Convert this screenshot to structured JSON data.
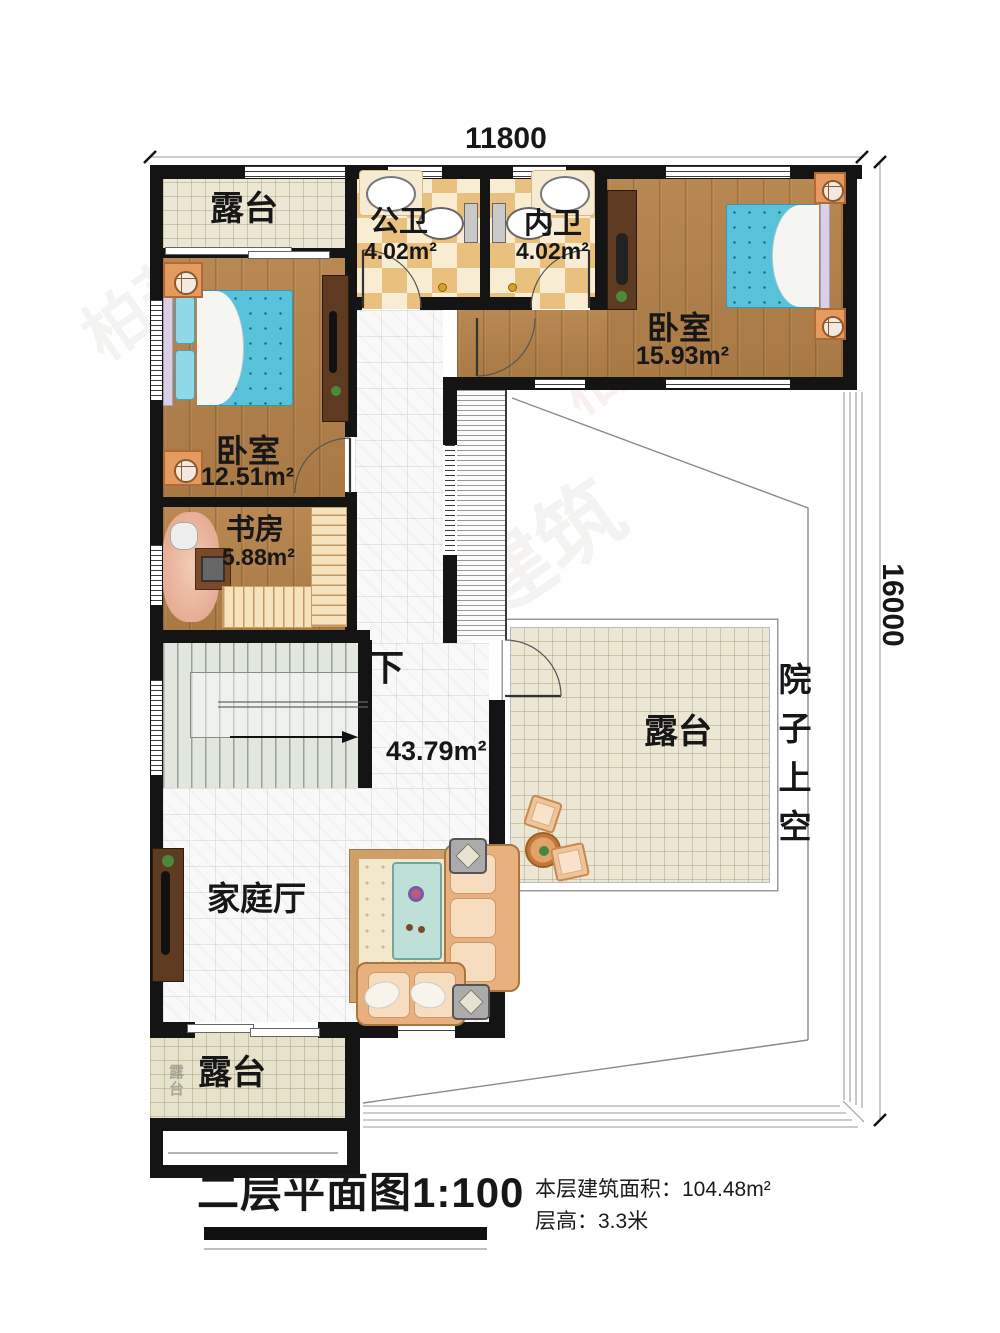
{
  "dimensions": {
    "top": "11800",
    "right": "16000"
  },
  "rooms": {
    "terrace_top": {
      "name": "露台"
    },
    "public_bath": {
      "name": "公卫",
      "area": "4.02m²"
    },
    "inner_bath": {
      "name": "内卫",
      "area": "4.02m²"
    },
    "bedroom_right": {
      "name": "卧室",
      "area": "15.93m²"
    },
    "bedroom_left": {
      "name": "卧室",
      "area": "12.51m²"
    },
    "study": {
      "name": "书房",
      "area": "5.88m²"
    },
    "hall": {
      "area": "43.79m²",
      "stair_direction": "下"
    },
    "family_hall": {
      "name": "家庭厅"
    },
    "terrace_center": {
      "name": "露台"
    },
    "terrace_bottom": {
      "name": "露台"
    },
    "courtyard": {
      "name": "院子上空"
    }
  },
  "footer": {
    "title": "二层平面图1:100",
    "area_label": "本层建筑面积：",
    "area_value": "104.48m²",
    "height_label": "层高：",
    "height_value": "3.3米"
  },
  "watermark": {
    "text": "柏菘建筑",
    "suffix": ".com",
    "ghost": "露台"
  }
}
